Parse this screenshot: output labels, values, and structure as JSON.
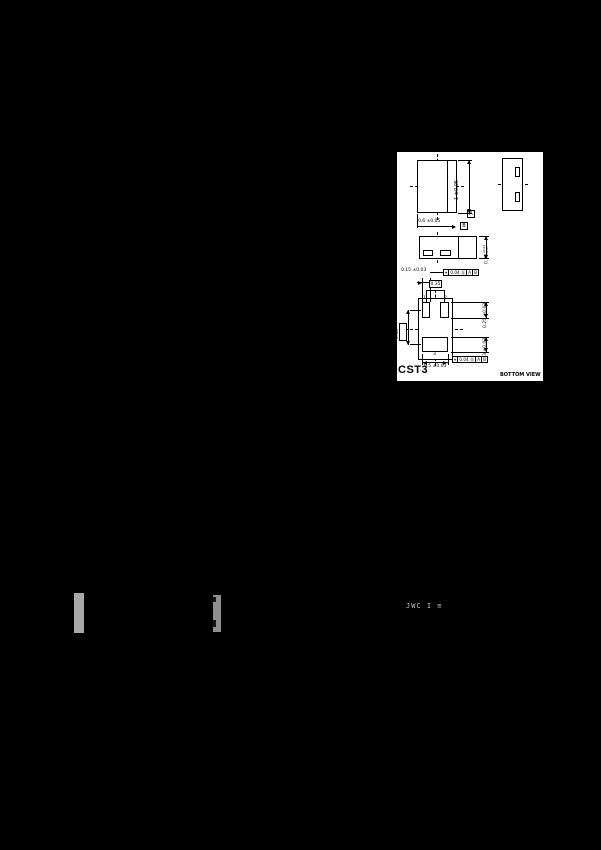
{
  "drawing": {
    "package_name": "CST3",
    "view_label": "BOTTOM VIEW",
    "top_view": {
      "length_dim": "1 ±0.05",
      "width_dim": "0.6 ±0.05",
      "datum_a": "A",
      "datum_b": "B"
    },
    "front_view": {
      "height_value": "0.38",
      "height_tol_plus": "+0.03",
      "height_tol_minus": "-0.05"
    },
    "bottom_view": {
      "pin1": "1",
      "pin2": "2",
      "pin3": "3",
      "terminal_width_dim": "0.15 ±0.03",
      "terminal_pitch_dim": "0.35",
      "pad12_length_dim": "0.25 ±0.03",
      "pad3_length_dim": "0.23 ±0.03",
      "pad3_width_dim": "0.5 ±0.03",
      "row_pitch_dim": "0.65",
      "fcf_top": {
        "symbol": "⌖",
        "tolerance": "0.04",
        "modifier": "Ⓢ",
        "datum1": "A",
        "datum2": "B"
      },
      "fcf_bottom": {
        "symbol": "⌖",
        "tolerance": "0.04",
        "modifier": "Ⓢ",
        "datum1": "A",
        "datum2": "B"
      }
    }
  },
  "photo": {
    "marking_text": "JWC I ≡"
  },
  "colors": {
    "background": "#000000",
    "panel": "#ffffff",
    "line": "#000000",
    "bar1": "#a8a8a8",
    "bar2": "#8f8f8f"
  }
}
